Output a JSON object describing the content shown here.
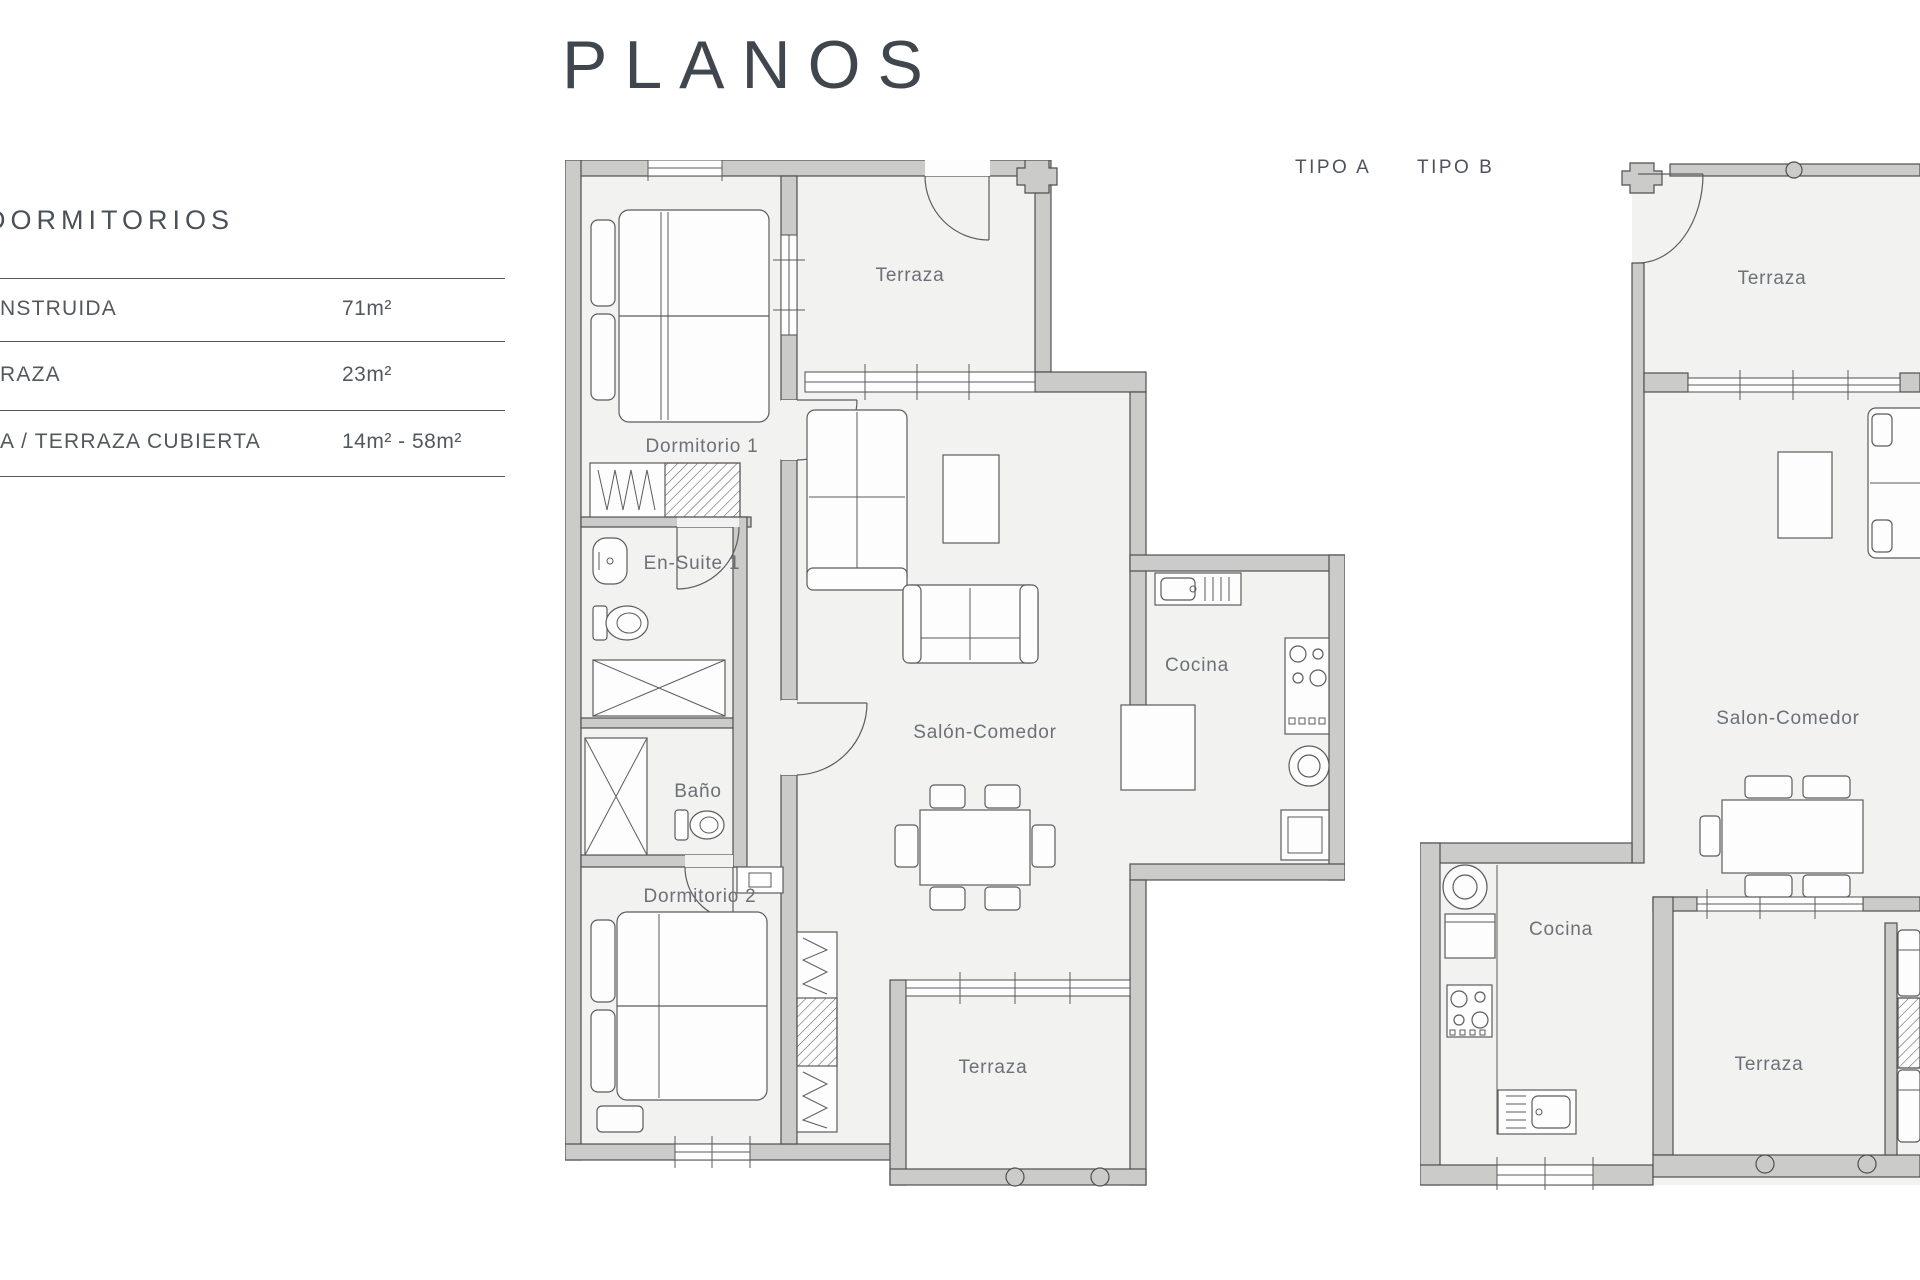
{
  "page": {
    "title": "PLANOS"
  },
  "sidebar": {
    "heading": "DORMITORIOS",
    "rows": [
      {
        "label": "NSTRUIDA",
        "value": "71m²"
      },
      {
        "label": "RAZA",
        "value": "23m²"
      },
      {
        "label": "A / TERRAZA CUBIERTA",
        "value": "14m² - 58m²"
      }
    ]
  },
  "plans": {
    "tipo_a": {
      "name": "TIPO A",
      "rooms": {
        "terraza_top": "Terraza",
        "dormitorio1": "Dormitorio 1",
        "ensuite": "En-Suite 1",
        "bano": "Baño",
        "dormitorio2": "Dormitorio 2",
        "salon": "Salón-Comedor",
        "cocina": "Cocina",
        "terraza_bottom": "Terraza"
      }
    },
    "tipo_b": {
      "name": "TIPO B",
      "rooms": {
        "terraza_top": "Terraza",
        "salon": "Salon-Comedor",
        "cocina": "Cocina",
        "terraza_bottom": "Terraza"
      }
    }
  },
  "colors": {
    "wall_fill": "#cbcbca",
    "wall_stroke": "#4f4f4f",
    "floor_fill": "#f2f2f1",
    "furniture_line": "#5c5c5c",
    "label_text": "#6b7176",
    "sidebar_text": "#53585d",
    "title_text": "#3f464d"
  }
}
